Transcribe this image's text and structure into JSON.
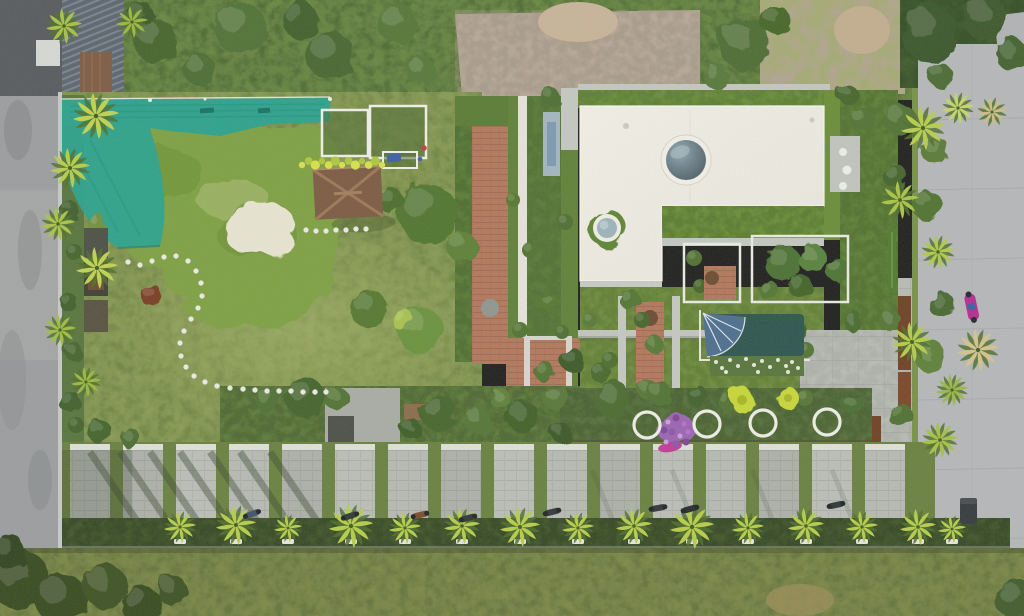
{
  "meta": {
    "type": "aerial-drone-photograph",
    "description": "Top-down aerial drone photo of a tropical villa plot: white L-shaped roof with circular skylights ringed by green roof gardens, a duckweed-covered pond with a white sand beach and teal shade nets, a brown hip-roof hut, lawns with a curved stepping-stone path, terracotta brick walkways, inner courtyards with a dark teal plunge pool and a slate-blue fan umbrella, a row of four white ring planters with purple flowers, a striped concrete-paver driveway with parked motorbikes, palm-lined roads on the left and right, and a grassy verge with small palms along the bottom.",
    "width": 1024,
    "height": 616
  },
  "palette": {
    "lawn": "#80934e",
    "lawn_dark": "#5a7434",
    "lawn_light": "#9aab5e",
    "pond_duckweed": "#7da13f",
    "pond_light": "#9cb465",
    "sand": "#eae6d3",
    "teal_net": "#2aa28c",
    "teal_net_dark": "#1c8f7a",
    "white_roof": "#f2efe7",
    "parapet_gray": "#c5c8c2",
    "roof_garden": "#6a8d37",
    "skylight_dome_dark": "#44545c",
    "brick": "#b3775c",
    "hut_roof": "#7b5941",
    "plunge_pool_teal": "#2a544c",
    "umbrella_slate_blue": "#4b6d8e",
    "paver": "#b7bbb4",
    "road_left": "#9b9d9f",
    "road_right": "#b6b8ba",
    "gravel": "#b6a896",
    "hedge_dark": "#3f5429",
    "verge_grass": "#73813e",
    "palm_yellow_green": "#b7ce49",
    "purple_flowers": "#9b63b3",
    "magenta_accent": "#c23a96",
    "corten_brown": "#6e3f22",
    "yellow_flower_hedge": "#d9e24c"
  },
  "scene": {
    "regions": [
      "left-road",
      "top-left-metal-roof-building",
      "top-scrub-band",
      "gravel-lot",
      "top-right-trees",
      "teal-shade-net",
      "duckweed-pond",
      "sand-beach",
      "white-frame-net-houses",
      "yellow-flower-hedge",
      "hut",
      "main-lawn",
      "stepping-stone-path",
      "brick-walkway",
      "lap-pool-strip",
      "villa-white-roof",
      "large-skylight",
      "small-skylight",
      "roof-gardens",
      "brick-courtyard",
      "tree-courtyard",
      "plunge-pool-courtyard",
      "fan-umbrella",
      "white-flower-bed",
      "yellow-flower-patches",
      "ring-planter-row",
      "purple-flower-bed",
      "southeast-paving",
      "corten-fence",
      "right-vertical-garden",
      "paver-driveway",
      "parked-motorbikes",
      "bottom-hedge-with-palms",
      "grass-verge",
      "right-road",
      "magenta-scooter",
      "trash-bin",
      "palm-trees"
    ],
    "stones": [
      [
        128,
        262
      ],
      [
        140,
        265
      ],
      [
        152,
        261
      ],
      [
        164,
        257
      ],
      [
        176,
        256
      ],
      [
        188,
        261
      ],
      [
        196,
        271
      ],
      [
        201,
        283
      ],
      [
        202,
        296
      ],
      [
        198,
        308
      ],
      [
        191,
        319
      ],
      [
        184,
        331
      ],
      [
        180,
        343
      ],
      [
        181,
        356
      ],
      [
        186,
        367
      ],
      [
        194,
        376
      ],
      [
        205,
        382
      ],
      [
        217,
        386
      ],
      [
        230,
        388
      ],
      [
        243,
        389
      ],
      [
        255,
        390
      ],
      [
        267,
        391
      ],
      [
        279,
        391
      ],
      [
        291,
        391
      ],
      [
        303,
        392
      ],
      [
        315,
        392
      ],
      [
        326,
        392
      ]
    ],
    "hutStones": [
      [
        306,
        230
      ],
      [
        316,
        231
      ],
      [
        326,
        231
      ],
      [
        336,
        230
      ],
      [
        346,
        230
      ],
      [
        356,
        229
      ],
      [
        366,
        229
      ]
    ],
    "rings": [
      [
        647,
        425
      ],
      [
        707,
        424
      ],
      [
        763,
        423
      ],
      [
        827,
        422
      ]
    ],
    "ringStyle": {
      "r": 13,
      "stroke": "#eff0e8",
      "width": 3.2
    },
    "yellowHedge": {
      "x0": 302,
      "x1": 382,
      "y": 163,
      "n": 13,
      "colors": [
        "#d9e24c",
        "#b0c83f"
      ]
    },
    "whiteFlowers": [
      [
        716,
        362
      ],
      [
        722,
        368
      ],
      [
        730,
        360
      ],
      [
        738,
        366
      ],
      [
        746,
        359
      ],
      [
        754,
        365
      ],
      [
        762,
        361
      ],
      [
        770,
        367
      ],
      [
        778,
        360
      ],
      [
        786,
        366
      ],
      [
        792,
        362
      ],
      [
        798,
        368
      ],
      [
        726,
        372
      ],
      [
        758,
        372
      ],
      [
        788,
        372
      ]
    ],
    "purpleDots": [
      [
        668,
        422
      ],
      [
        676,
        418
      ],
      [
        684,
        424
      ],
      [
        672,
        432
      ],
      [
        680,
        436
      ],
      [
        664,
        430
      ],
      [
        688,
        432
      ],
      [
        676,
        444
      ],
      [
        666,
        442
      ],
      [
        686,
        442
      ]
    ],
    "purpleDotColors": [
      "#c9a0dc",
      "#7e4596",
      "#b86fc9",
      "#8d54a6"
    ],
    "trees": [
      [
        155,
        40,
        22,
        "#44632c"
      ],
      [
        240,
        28,
        26,
        "#507134"
      ],
      [
        330,
        55,
        24,
        "#46652e"
      ],
      [
        398,
        24,
        20,
        "#547536"
      ],
      [
        300,
        20,
        18,
        "#3f5e29"
      ],
      [
        200,
        70,
        16,
        "#4c6c31"
      ],
      [
        420,
        70,
        14,
        "#557837"
      ],
      [
        745,
        44,
        26,
        "#4c6c31"
      ],
      [
        716,
        76,
        13,
        "#557837"
      ],
      [
        775,
        20,
        15,
        "#456528"
      ],
      [
        930,
        34,
        28,
        "#39542a"
      ],
      [
        985,
        18,
        22,
        "#3b5629"
      ],
      [
        1012,
        55,
        16,
        "#42602e"
      ],
      [
        940,
        75,
        12,
        "#4a6a32"
      ],
      [
        140,
        15,
        14,
        "#3c5828"
      ],
      [
        428,
        214,
        30,
        "#4f742d"
      ],
      [
        462,
        247,
        15,
        "#5b8034"
      ],
      [
        390,
        200,
        13,
        "#4b6c2b"
      ],
      [
        368,
        308,
        19,
        "#55772e"
      ],
      [
        420,
        330,
        23,
        "#68923a"
      ],
      [
        404,
        321,
        11,
        "#a9c24e"
      ],
      [
        152,
        296,
        11,
        "#7a3b22"
      ],
      [
        97,
        223,
        9,
        "#6d9140"
      ],
      [
        70,
        210,
        9,
        "#3f5e2a"
      ],
      [
        74,
        252,
        8,
        "#44632c"
      ],
      [
        68,
        302,
        9,
        "#3f5e2a"
      ],
      [
        74,
        352,
        9,
        "#44632c"
      ],
      [
        70,
        402,
        11,
        "#3f5e2a"
      ],
      [
        100,
        432,
        12,
        "#42632a"
      ],
      [
        130,
        438,
        10,
        "#4c6c31"
      ],
      [
        76,
        425,
        8,
        "#42632a"
      ],
      [
        268,
        400,
        14,
        "#4e7030"
      ],
      [
        305,
        397,
        20,
        "#42632a"
      ],
      [
        336,
        398,
        12,
        "#517232"
      ],
      [
        438,
        412,
        18,
        "#45652c"
      ],
      [
        478,
        420,
        14,
        "#527434"
      ],
      [
        522,
        416,
        16,
        "#3f5f28"
      ],
      [
        556,
        398,
        13,
        "#567737"
      ],
      [
        560,
        432,
        10,
        "#3a5726"
      ],
      [
        500,
        398,
        10,
        "#5d8038"
      ],
      [
        410,
        428,
        10,
        "#3d5b26"
      ],
      [
        513,
        200,
        7,
        "#55772f"
      ],
      [
        530,
        250,
        8,
        "#507231"
      ],
      [
        548,
        300,
        9,
        "#55772f"
      ],
      [
        565,
        222,
        8,
        "#4c6e30"
      ],
      [
        520,
        330,
        8,
        "#507231"
      ],
      [
        562,
        332,
        7,
        "#4c6e30"
      ],
      [
        550,
        96,
        9,
        "#4c6e30"
      ],
      [
        572,
        360,
        12,
        "#3a5826"
      ],
      [
        545,
        372,
        10,
        "#517331"
      ],
      [
        600,
        372,
        10,
        "#46682c"
      ],
      [
        612,
        398,
        18,
        "#486a2e"
      ],
      [
        648,
        390,
        10,
        "#557634"
      ],
      [
        660,
        394,
        12,
        "#507231"
      ],
      [
        698,
        396,
        10,
        "#3f6029"
      ],
      [
        726,
        400,
        9,
        "#517233"
      ],
      [
        805,
        398,
        8,
        "#557535"
      ],
      [
        852,
        404,
        10,
        "#4a6c30"
      ],
      [
        782,
        262,
        18,
        "#4a7030"
      ],
      [
        812,
        258,
        14,
        "#57813a"
      ],
      [
        800,
        286,
        12,
        "#3f6328"
      ],
      [
        768,
        290,
        10,
        "#517631"
      ],
      [
        838,
        270,
        12,
        "#4c7231"
      ],
      [
        694,
        258,
        8,
        "#4e7030"
      ],
      [
        700,
        286,
        7,
        "#436528"
      ],
      [
        630,
        300,
        10,
        "#517431"
      ],
      [
        642,
        320,
        8,
        "#43652a"
      ],
      [
        654,
        344,
        9,
        "#557834"
      ],
      [
        610,
        360,
        8,
        "#4a6c2e"
      ],
      [
        590,
        320,
        7,
        "#567836"
      ],
      [
        798,
        332,
        10,
        "#3e6027"
      ],
      [
        806,
        350,
        8,
        "#517331"
      ],
      [
        900,
        120,
        16,
        "#4f7231"
      ],
      [
        935,
        150,
        14,
        "#587a36"
      ],
      [
        895,
        176,
        12,
        "#43642b"
      ],
      [
        928,
        206,
        15,
        "#50722f"
      ],
      [
        942,
        305,
        13,
        "#46672d"
      ],
      [
        890,
        320,
        10,
        "#527436"
      ],
      [
        930,
        356,
        16,
        "#5d8038"
      ],
      [
        900,
        415,
        12,
        "#4e7030"
      ],
      [
        852,
        320,
        10,
        "#476a2d"
      ],
      [
        862,
        120,
        12,
        "#517231"
      ],
      [
        848,
        95,
        10,
        "#44652b"
      ],
      [
        20,
        580,
        30,
        "#35491f"
      ],
      [
        62,
        600,
        26,
        "#35491f"
      ],
      [
        105,
        586,
        22,
        "#3b5122"
      ],
      [
        142,
        606,
        20,
        "#35491f"
      ],
      [
        172,
        590,
        15,
        "#3b5122"
      ],
      [
        1014,
        598,
        20,
        "#3f5a2a"
      ],
      [
        8,
        552,
        18,
        "#2f421c"
      ]
    ],
    "palms": {
      "bottom": [
        [
          180,
          527,
          0.8
        ],
        [
          236,
          525,
          1.0
        ],
        [
          288,
          528,
          0.7
        ],
        [
          351,
          526,
          1.1
        ],
        [
          405,
          528,
          0.8
        ],
        [
          462,
          526,
          0.9
        ],
        [
          520,
          527,
          1.0
        ],
        [
          578,
          528,
          0.8
        ],
        [
          634,
          526,
          0.9
        ],
        [
          692,
          527,
          1.1
        ],
        [
          748,
          528,
          0.8
        ],
        [
          806,
          526,
          0.9
        ],
        [
          862,
          527,
          0.8
        ],
        [
          918,
          527,
          0.9
        ],
        [
          952,
          529,
          0.7
        ]
      ],
      "left": [
        [
          64,
          26,
          0.9,
          "#a9c243"
        ],
        [
          96,
          116,
          1.15,
          "#c1d44f"
        ],
        [
          70,
          168,
          1.0,
          "#b7ce49"
        ],
        [
          58,
          224,
          0.85,
          "#aac544"
        ],
        [
          97,
          268,
          1.05,
          "#c1d44f"
        ],
        [
          60,
          330,
          0.8,
          "#a3bd40"
        ],
        [
          86,
          382,
          0.75,
          "#9cb83e"
        ],
        [
          132,
          22,
          0.8,
          "#9cb83e"
        ]
      ],
      "right": [
        [
          923,
          128,
          1.1,
          "#b8cf4a"
        ],
        [
          958,
          108,
          0.8,
          "#c9d66a"
        ],
        [
          992,
          112,
          0.75,
          "#cbbd86"
        ],
        [
          900,
          200,
          0.95,
          "#aac544"
        ],
        [
          938,
          252,
          0.85,
          "#b2ca46"
        ],
        [
          912,
          342,
          1.0,
          "#b5cc48"
        ],
        [
          978,
          350,
          1.05,
          "#d6c48e"
        ],
        [
          940,
          440,
          0.9,
          "#a8c243"
        ],
        [
          952,
          390,
          0.8,
          "#9db845"
        ]
      ]
    },
    "palmStoneColor": "#e8e8df",
    "driveway": {
      "x0": 70,
      "x1": 908,
      "capY": 444,
      "topY": 450,
      "botY": 520,
      "stripW": 40,
      "gapW": 13,
      "capFill": "#e0e3db"
    },
    "bikes": [
      [
        252,
        514,
        -20,
        "#3b506b"
      ],
      [
        350,
        516,
        -18,
        "#2f3437"
      ],
      [
        420,
        515,
        -14,
        "#7a4a2c"
      ],
      [
        468,
        518,
        -15,
        "#2f3437"
      ],
      [
        552,
        512,
        -14,
        "#2f3437"
      ],
      [
        658,
        508,
        -10,
        "#2f3437"
      ],
      [
        690,
        509,
        -15,
        "#24292c"
      ],
      [
        836,
        505,
        -12,
        "#2f3437"
      ]
    ],
    "skylights": {
      "large": {
        "cx": 686,
        "cy": 160,
        "r": 21
      },
      "small": {
        "cx": 607,
        "cy": 228,
        "r": 10
      }
    }
  }
}
